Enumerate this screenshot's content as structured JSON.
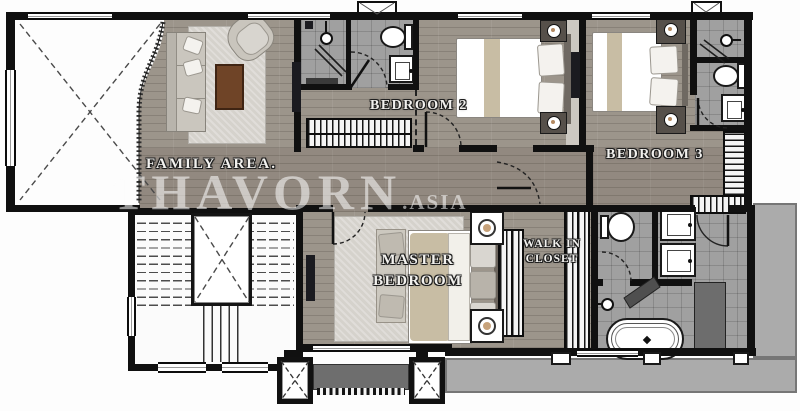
{
  "watermark": {
    "brand": "THAVORN",
    "suffix": ".ASIA"
  },
  "labels": {
    "family_area": "FAMILY AREA.",
    "bedroom2": "BEDROOM 2",
    "bedroom3": "BEDROOM 3",
    "master_line1": "MASTER",
    "master_line2": "BEDROOM",
    "walkin_line1": "WALK IN",
    "walkin_line2": "CLOSET"
  },
  "colors": {
    "wall": "#101010",
    "wood_floor": "#9c958b",
    "tile_floor": "#a0a0a0",
    "terrace": "#ababab",
    "rug": "#d5d2cc",
    "duvet_tan": "#c8bda4",
    "coffee_table": "#6f4427",
    "planter": "#6e6e6e",
    "fixture_white": "#ffffff"
  }
}
